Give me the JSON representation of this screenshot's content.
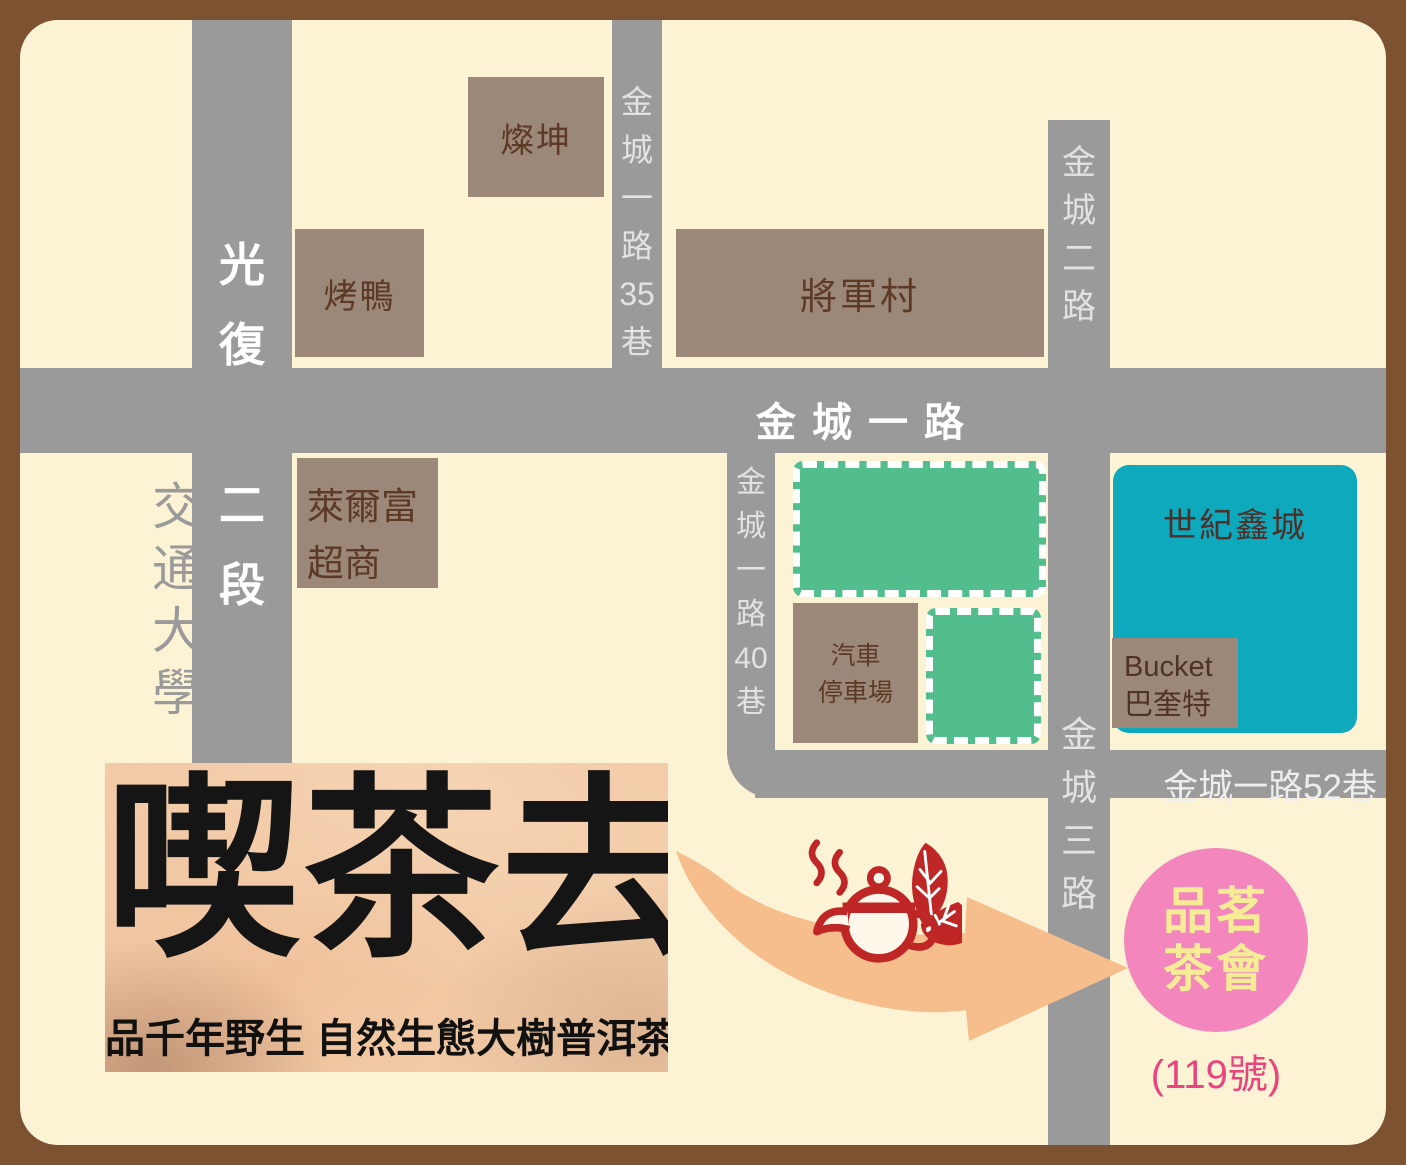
{
  "colors": {
    "frame_brown": "#7D5231",
    "background_cream": "#FCF3D4",
    "road_gray": "#9A9A9A",
    "road_label_light": "#E2E2E2",
    "building_brown": "#9C8878",
    "building_text_brown": "#5C3A26",
    "green_block": "#52BE8E",
    "teal_building": "#0FA9BE",
    "arrow_orange": "#F5BE8C",
    "teapot_red": "#BF2626",
    "circle_pink": "#F286BD",
    "circle_text_yellow": "#F7EC96",
    "note_pink": "#E8457F"
  },
  "roads": {
    "guangfu": {
      "name": "光復路二段",
      "chars": [
        "光",
        "復",
        "路",
        "二",
        "段"
      ]
    },
    "lane35": {
      "name": "金城一路35巷",
      "chars": [
        "金",
        "城",
        "一",
        "路",
        "35",
        "巷"
      ]
    },
    "jincheng2": {
      "name": "金城二路",
      "chars": [
        "金",
        "城",
        "二",
        "路"
      ]
    },
    "main": {
      "label": "金城一路"
    },
    "lane40": {
      "name": "金城一路40巷",
      "chars": [
        "金",
        "城",
        "一",
        "路",
        "40",
        "巷"
      ]
    },
    "lane52": {
      "label": "金城一路52巷"
    },
    "jincheng3": {
      "name": "金城三路",
      "chars": [
        "金",
        "城",
        "三",
        "路"
      ]
    }
  },
  "landmarks": {
    "university": {
      "name": "交通大學",
      "chars": [
        "交",
        "通",
        "大",
        "學"
      ]
    },
    "tsannkuan": {
      "label": "燦坤"
    },
    "roast_duck": {
      "label": "烤鴨"
    },
    "general_village": {
      "label": "將軍村"
    },
    "hilife": {
      "line1": "萊爾富",
      "line2": "超商"
    },
    "parking": {
      "line1": "汽車",
      "line2": "停車場"
    },
    "century_xin": {
      "label": "世紀鑫城"
    },
    "bucket": {
      "line1": "Bucket",
      "line2": "巴奎特"
    }
  },
  "promo": {
    "title": "喫茶去",
    "subtitle": "品千年野生 自然生態大樹普洱茶"
  },
  "destination": {
    "line1": "品茗",
    "line2": "茶會",
    "note": "(119號)"
  },
  "icons": {
    "teapot": "steaming-teapot-icon",
    "leaves": "tea-leaves-icon",
    "arrow": "direction-arrow"
  }
}
